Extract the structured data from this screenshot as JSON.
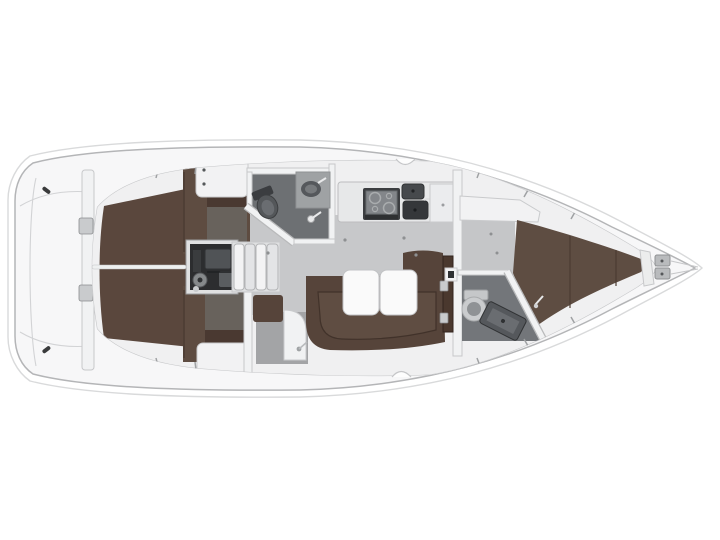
{
  "scene": {
    "subject": "sailing-yacht-interior-layout-plan",
    "view": "top-down",
    "bow_direction": "right",
    "background": "#ffffff"
  },
  "areas": {
    "bathing_platform": "fold-down transom platform",
    "cockpit": "cockpit sole",
    "port_aft_cabin": "aft cabin port berth",
    "starboard_aft_cabin": "aft cabin starboard berth",
    "engine_compartment": "engine under companionway",
    "companionway": "companionway steps",
    "aft_head": "aft head with toilet and sink",
    "galley": "galley with stove and twin sinks",
    "salon": "salon with U-settee and folding table",
    "forward_head": "forward head with toilet and shower",
    "forward_cabin": "forward V-berth cabin",
    "anchor_locker": "bow anchor locker"
  },
  "colors": {
    "background": "#ffffff",
    "hull": "#f7f7f8",
    "hull_outline": "#b4b5b7",
    "lifeline": "#d9dadb",
    "deck_line": "#c6c7c9",
    "interior_base": "#f0f0f1",
    "salon_floor": "#c7c8ca",
    "fwd_floor": "#c5c6c8",
    "corridor_floor": "#a3a4a6",
    "cabin_floor_dark": "#68625c",
    "wet_floor": "#6d7073",
    "wet_floor_fwd": "#73767a",
    "cockpit_sole": "#5a473d",
    "berth_brown": "#5e4c41",
    "settee_brown": "#56443a",
    "settee_seat": "#5f4d42",
    "vberth_brown": "#5e4d42",
    "upholstery_seam": "#46372e",
    "cabinet_dark_brown": "#4a3931",
    "door_wood": "#4a382e",
    "furniture_white": "#f2f2f3",
    "wall_white": "#f1f2f3",
    "table_white": "#fafafa",
    "engine_box": "#e0e1e2",
    "engine_dark": "#2c2d2f",
    "engine_body": "#86898b",
    "appliance_dark": "#3b3d40",
    "appliance_mid": "#83868a",
    "sink_dark": "#46494c",
    "sink_darker": "#35373a",
    "fixture_gray": "#55585c",
    "fixture_mid": "#6a6d71",
    "toilet_gray": "#caccce",
    "toilet_inner": "#8f9295",
    "counter_gray": "#9fa2a4",
    "locker_gray": "#b9bbbd"
  }
}
